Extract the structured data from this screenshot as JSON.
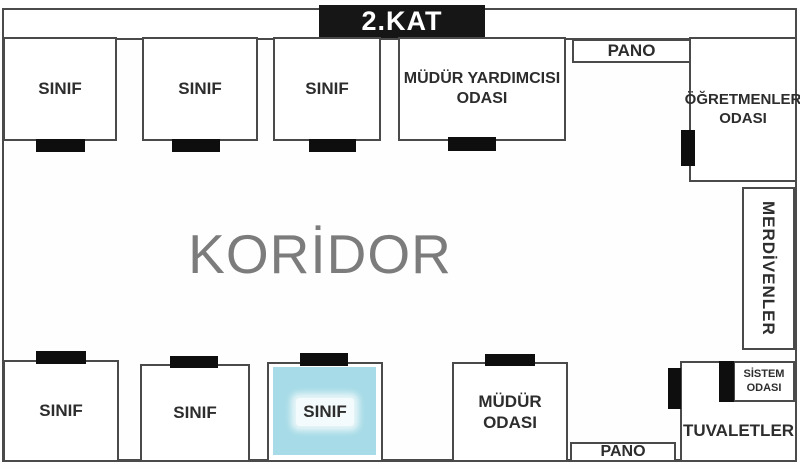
{
  "floor": {
    "title": "2.KAT"
  },
  "corridor": {
    "label": "KORİDOR"
  },
  "rooms": {
    "sinif_label": "SINIF",
    "mudur_yardimcisi": {
      "line1": "MÜDÜR YARDIMCISI",
      "line2": "ODASI"
    },
    "ogretmenler": {
      "line1": "ÖĞRETMENLER",
      "line2": "ODASI"
    },
    "merdivenler": {
      "label": "MERDİVENLER"
    },
    "mudur": {
      "line1": "MÜDÜR",
      "line2": "ODASI"
    },
    "tuvaletler": {
      "label": "TUVALETLER"
    },
    "sistem": {
      "line1": "SİSTEM",
      "line2": "ODASI"
    },
    "pano_top": {
      "label": "PANO"
    },
    "pano_bottom": {
      "label": "PANO"
    }
  },
  "highlighted_room": "sinif-bottom-3",
  "colors": {
    "wall": "#4a4a4a",
    "door": "#0e0e0e",
    "title_bg": "#161616",
    "title_text": "#ffffff",
    "corridor_text": "#7c7c7c",
    "highlight_fill": "#a6dbe7"
  }
}
